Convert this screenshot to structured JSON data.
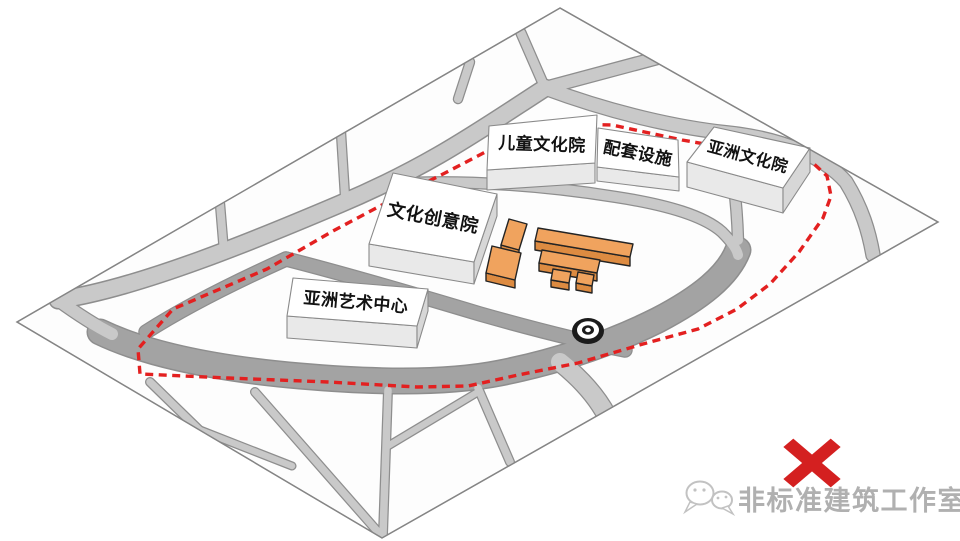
{
  "diagram": {
    "kind": "axonometric-site-plan",
    "buildings": [
      {
        "label": "儿童文化院"
      },
      {
        "label": "配套设施"
      },
      {
        "label": "亚洲文化院"
      },
      {
        "label": "文化创意院"
      },
      {
        "label": "亚洲艺术中心"
      }
    ],
    "markers": {
      "site_boundary_color": "#e32020",
      "rejection_mark_color": "#d42020",
      "massing_block_color": "#f0a35e"
    },
    "watermark": {
      "text": "非标准建筑工作室"
    }
  }
}
